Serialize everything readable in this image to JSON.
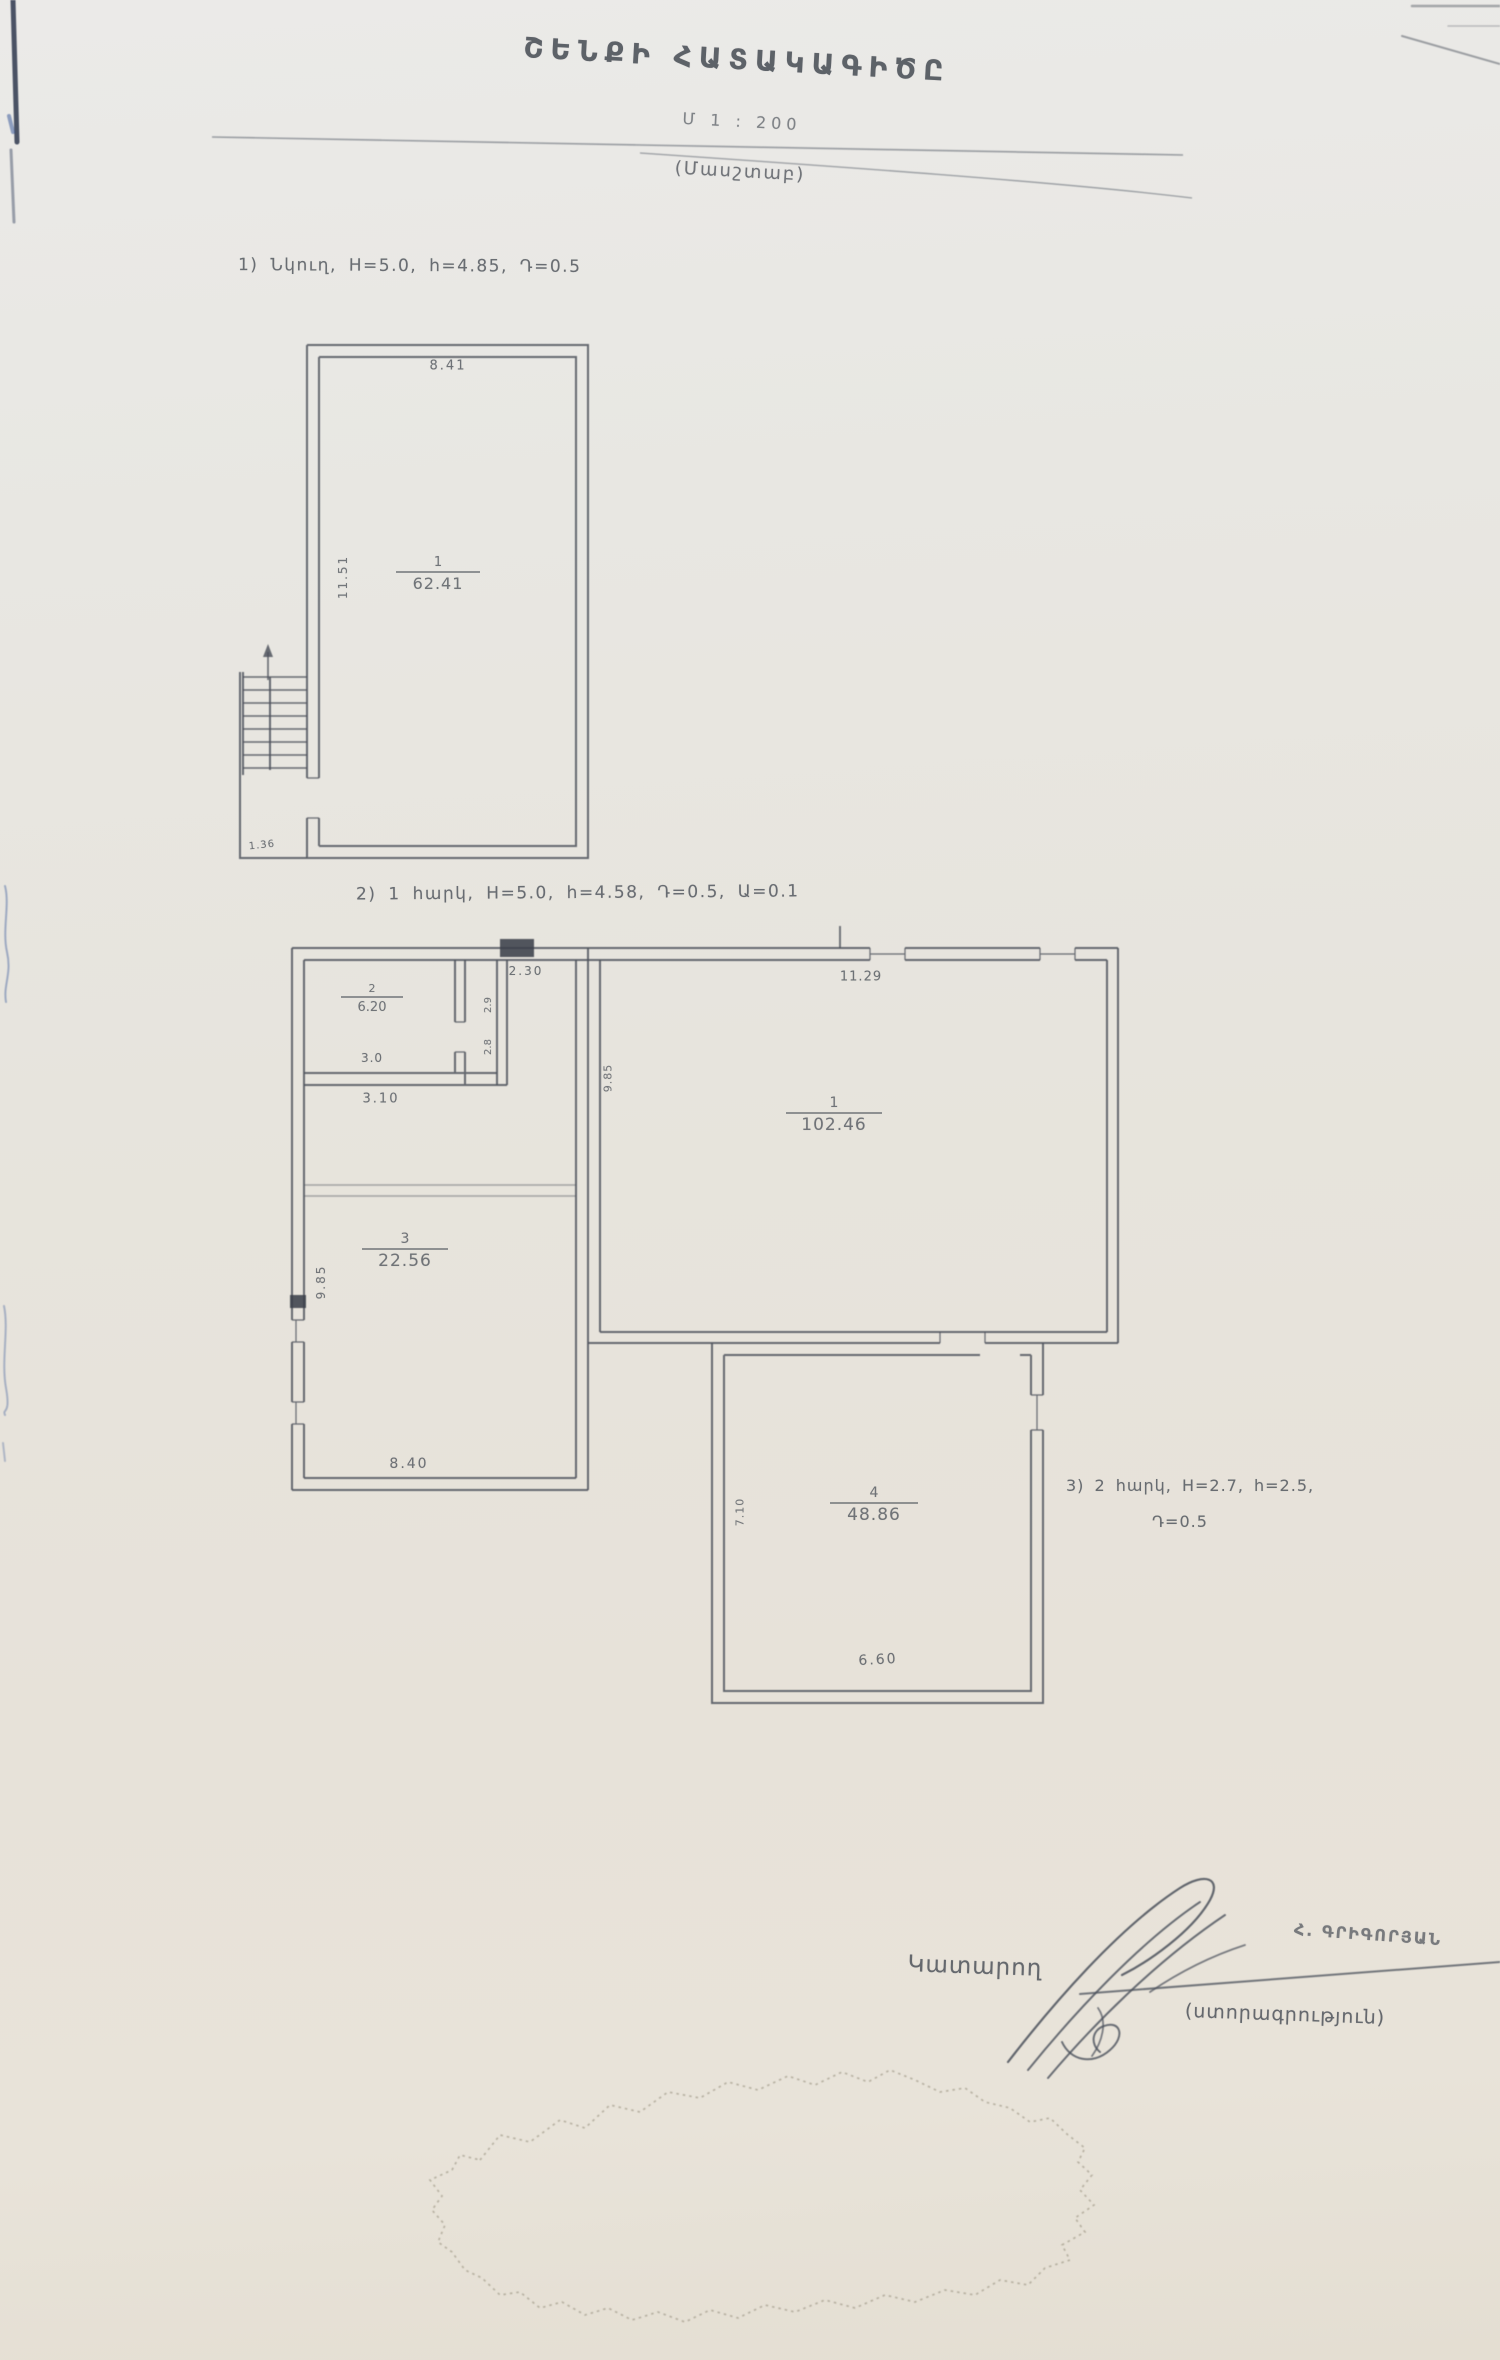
{
  "document": {
    "title": "ՇԵՆՔԻ ՀԱՏԱԿԱԳԻԾԸ",
    "scale": {
      "value": "Մ 1 : 200",
      "caption": "(Մասշտաբ)"
    },
    "notes": {
      "basement": "1) Նկուղ, H=5.0, h=4.85, Դ=0.5",
      "floor1": "2) 1 հարկ, H=5.0, h=4.58, Դ=0.5, Ա=0.1",
      "floor2_line1": "3) 2 հարկ, H=2.7, h=2.5,",
      "floor2_line2": "Դ=0.5"
    }
  },
  "plans": {
    "basement": {
      "room1": {
        "number": "1",
        "area": "62.41"
      },
      "dims": {
        "top": "8.41",
        "left": "11.51",
        "stair": "1.36"
      }
    },
    "floor1": {
      "room1": {
        "number": "1",
        "area": "102.46"
      },
      "room2": {
        "number": "2",
        "area": "6.20"
      },
      "room3": {
        "number": "3",
        "area": "22.56"
      },
      "room4": {
        "number": "4",
        "area": "48.86"
      },
      "dims": {
        "room1_top": "11.29",
        "room1_left": "9.85",
        "room2_inner": "3.0",
        "room2_bottom": "3.10",
        "corridor_top": "2.30",
        "corridor_upper": "2.9",
        "corridor_lower": "2.8",
        "block_left": "9.85",
        "room3_bottom": "8.40",
        "room4_left": "7.10",
        "room4_bottom": "6.60"
      }
    }
  },
  "signature": {
    "role": "Կատարող",
    "name": "Հ. ԳՐԻԳՈՐՅԱՆ",
    "caption": "(ստորագրություն)"
  },
  "colors": {
    "paper": "#e8e5de",
    "ink": "#53585f",
    "pen": "#2e4f96",
    "stamp": "#98917f"
  }
}
